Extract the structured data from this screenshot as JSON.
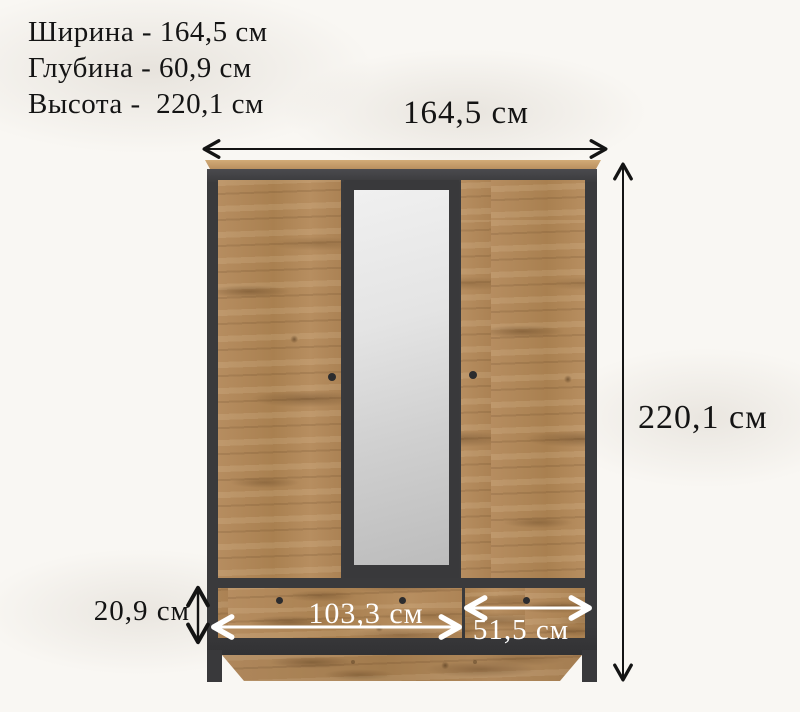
{
  "specs": {
    "lines": [
      {
        "text": "Ширина - 164,5 см"
      },
      {
        "text": "Глубина - 60,9 см"
      },
      {
        "text": "Высота -  220,1 см"
      }
    ]
  },
  "dimensions": {
    "width_label": "164,5 см",
    "height_label": "220,1 см",
    "drawer_height_label": "20,9 см",
    "wide_drawer_label": "103,3 см",
    "narrow_drawer_label": "51,5 см"
  },
  "colors": {
    "background": "#f9f7f3",
    "wood": "#b0875a",
    "frame_dark": "#3a3a3c",
    "top_board": "#c49a6a",
    "mirror": "#d9d9d9",
    "dimension_text": "#141414",
    "drawer_label_text": "#ffffff"
  }
}
